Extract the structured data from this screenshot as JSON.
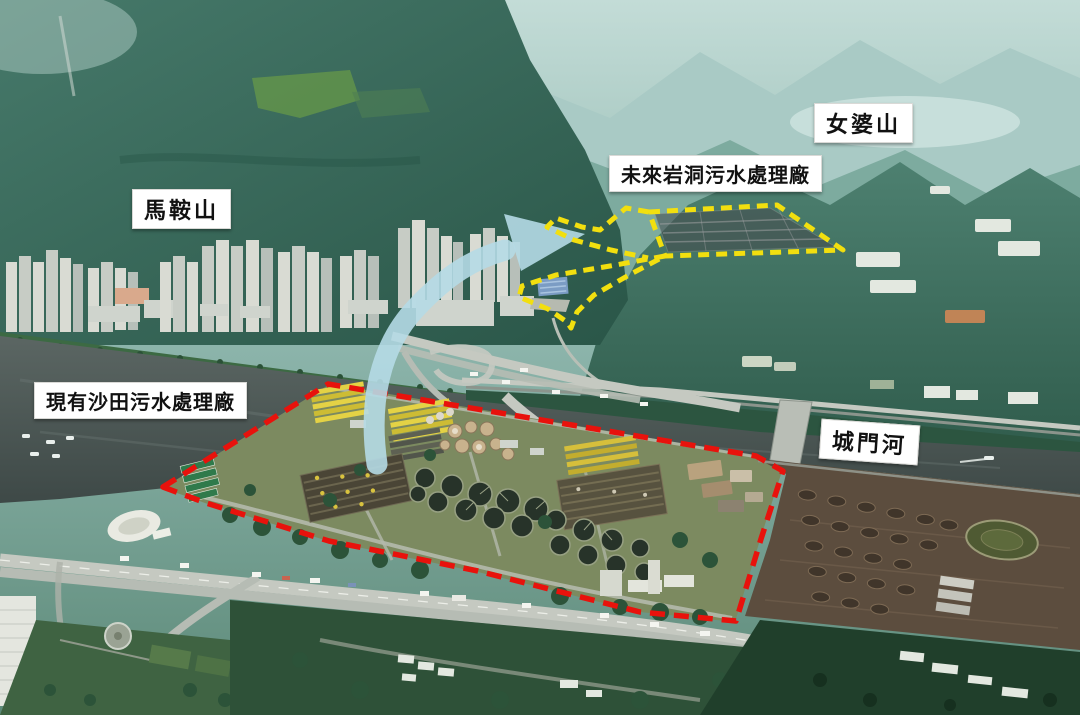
{
  "labels": {
    "ma_on_shan": "馬鞍山",
    "nui_po_shan": "女婆山",
    "future_cavern_stw": "未來岩洞污水處理廠",
    "existing_shatin_stw": "現有沙田污水處理廠",
    "shing_mun_river": "城門河"
  },
  "overlays": {
    "existing_boundary_color": "#e8120c",
    "future_boundary_color": "#f2df0f",
    "arrow_color": "#b5dae6",
    "cavern_footprint_fill": "rgba(70,72,76,0.55)",
    "label_background": "#ffffff",
    "label_text_color": "#111111"
  }
}
